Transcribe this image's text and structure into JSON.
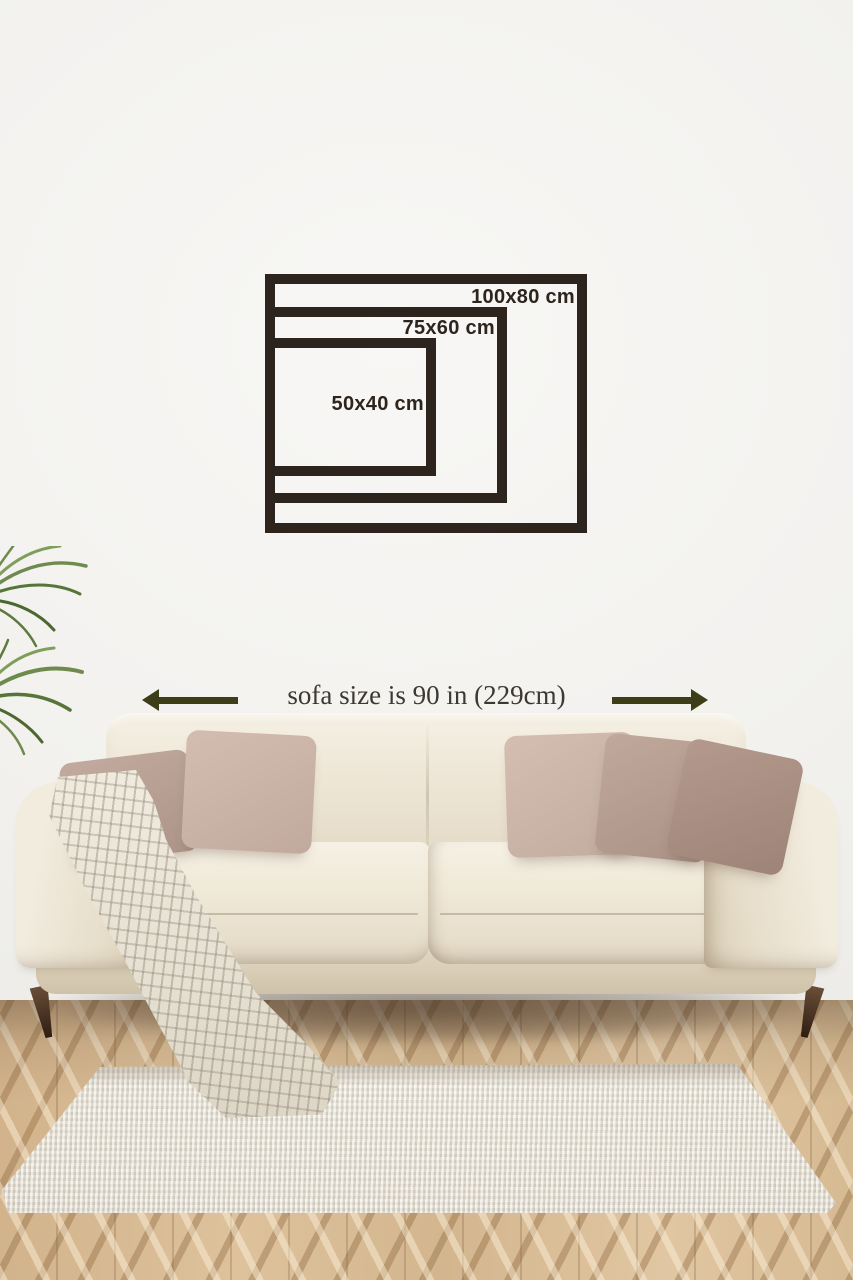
{
  "size_guide": {
    "title": "wall art size comparison",
    "frames": [
      {
        "id": "100x80",
        "label": "100x80 cm",
        "width_cm": 100,
        "height_cm": 80
      },
      {
        "id": "75x60",
        "label": "75x60 cm",
        "width_cm": 75,
        "height_cm": 60
      },
      {
        "id": "50x40",
        "label": "50x40 cm",
        "width_cm": 50,
        "height_cm": 40
      }
    ],
    "frame_color": "#2d241d",
    "label_color": "#2d241d"
  },
  "sofa_annotation": {
    "text": "sofa size is 90 in (229cm)",
    "sofa_width_in": 90,
    "sofa_width_cm": 229,
    "text_color": "#3c3833",
    "arrow_color": "#3d3d17",
    "icons": [
      "arrow-left-icon",
      "arrow-right-icon"
    ]
  },
  "scene": {
    "wall_color": "#f2f1ee",
    "floor_color": "#d3b68e",
    "floor_pattern": "herringbone-wood",
    "rug_color": "#e8e3d9",
    "sofa_color": "#ece5d6",
    "sofa_leg_color": "#4a3524",
    "throw_color": "#e9e4d8",
    "plant_color": "#6e8b4d",
    "pillow_colors": [
      "#b7a094",
      "#cab4a8",
      "#cbb5a9",
      "#b69e92",
      "#a98f83"
    ]
  }
}
